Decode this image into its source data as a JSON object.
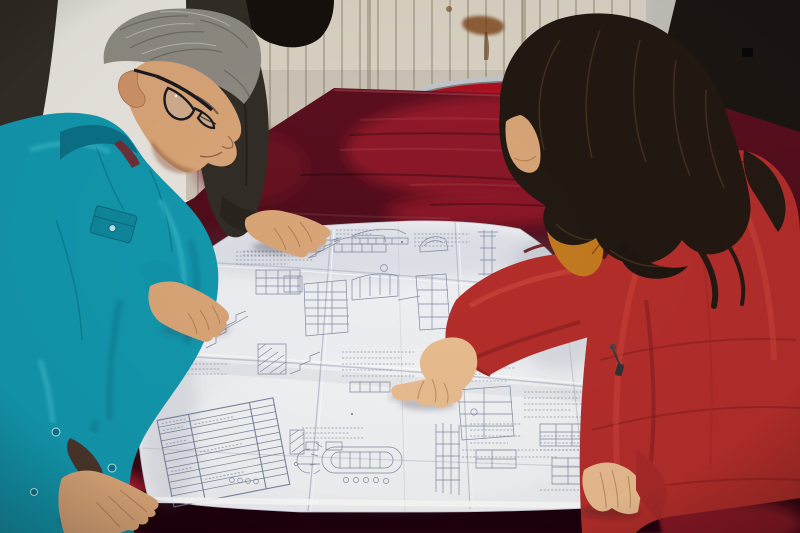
{
  "meta": {
    "type": "photograph",
    "description": "Two workers lean over a large folded engineering blueprint spread on a table draped in dark red velvet: a gray-haired man in a teal work jacket with glasses on the left, a colleague in a dark jacket resting a hand on the drawing, and a woman in a red down coat with an orange fur-trimmed hood pointing at a detail."
  },
  "colors": {
    "wall": "#eae6df",
    "radiator": "#dcd5c6",
    "radiator_slat": "#b3aa98",
    "door": "#1c1613",
    "door_strip": "#d8d5cf",
    "rust": "#7c4216",
    "chair_metal": "#c3c7cb",
    "chair_red": "#ad1220",
    "velvet": "#5d0f1f",
    "velvet_bright": "#a61a2e",
    "velvet_deep": "#1e0309",
    "paper": "#eff0f3",
    "ink": "#6f7a94",
    "crease": "#b9bdca",
    "jacket_teal": "#1398ae",
    "jacket_teal_dark": "#0b7187",
    "collar_inner": "#6e3038",
    "hair_gray": "#8f8b83",
    "hair_gray_dark": "#57534c",
    "skin": "#daa678",
    "skin_light": "#e9bd8f",
    "skin_shadow": "#b27a50",
    "dark_jacket": "#332d27",
    "black_hair": "#17110d",
    "woman_hair": "#231912",
    "hair_highlight": "#5e4326",
    "fur_orange": "#c47b20",
    "fur_dark": "#6e3c0e",
    "coat_red": "#b52e2b",
    "coat_red_dark": "#7c1a1a",
    "coat_red_light": "#d04a3c",
    "zipper": "#333336",
    "glasses": "#1b1b1f"
  },
  "scene": {
    "background": {
      "wall": "plaster wall",
      "radiator": "cream radiator with vertical fins",
      "door": "dark door on the right",
      "stain": "rust stain on wall"
    },
    "furniture": {
      "table": "table covered with dark red velvet cloth",
      "chair": "red-backed chair with metal tube frame"
    },
    "people": [
      {
        "id": "engineer-left",
        "description": "gray-haired man, glasses, teal work jacket, hands on the drawing"
      },
      {
        "id": "colleague-behind",
        "description": "person in dark jacket, hand resting on the blueprint"
      },
      {
        "id": "woman-right",
        "description": "woman, long dark hair, red down coat with orange fur hood, pointing at the drawing"
      }
    ],
    "blueprint": {
      "description": "large folded white construction drawing: stair sections, beam elevations, schedule tables, stadium-shaped detail",
      "folds": "grid of fold creases"
    }
  }
}
